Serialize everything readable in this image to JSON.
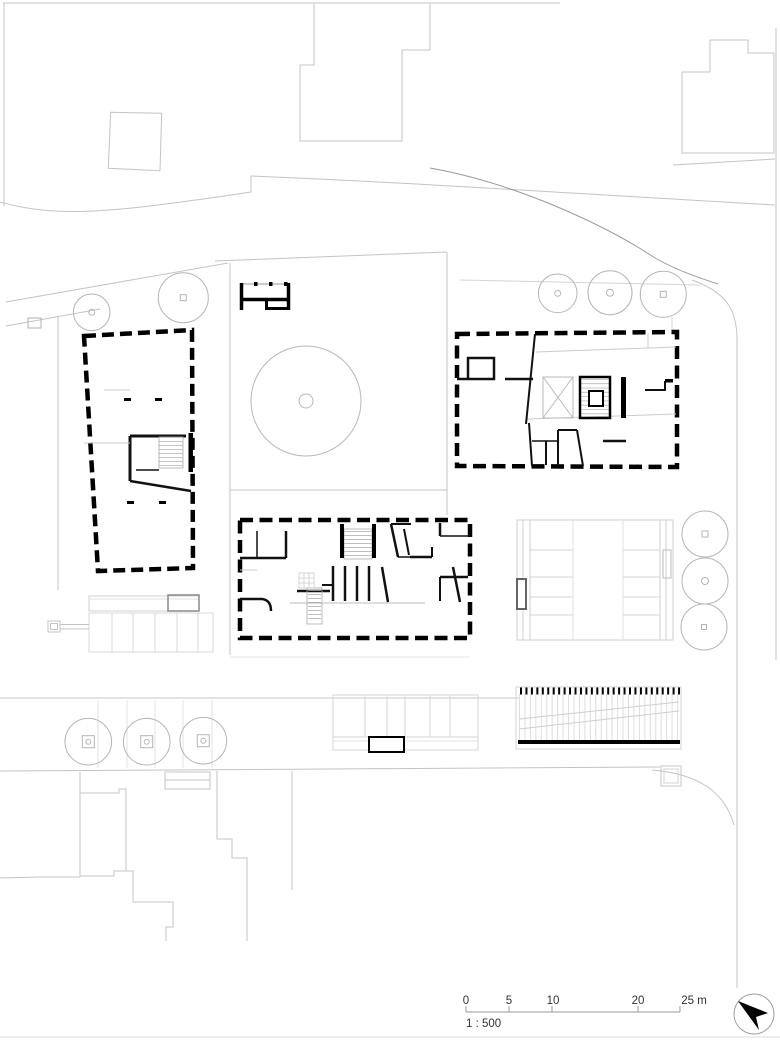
{
  "drawing": {
    "kind": "architectural site plan"
  },
  "scale_bar": {
    "labels": [
      "0",
      "5",
      "10",
      "20",
      "25 m"
    ],
    "ratio": "1 : 500"
  },
  "icons": {
    "north_arrow": "north-arrow"
  },
  "colors": {
    "wall": "#000000",
    "interior_wall": "#111111",
    "context_line": "#c4c4c4",
    "faint_line": "#dedede",
    "medium_line": "#9a9a9a",
    "paper": "#ffffff",
    "text": "#333333"
  }
}
